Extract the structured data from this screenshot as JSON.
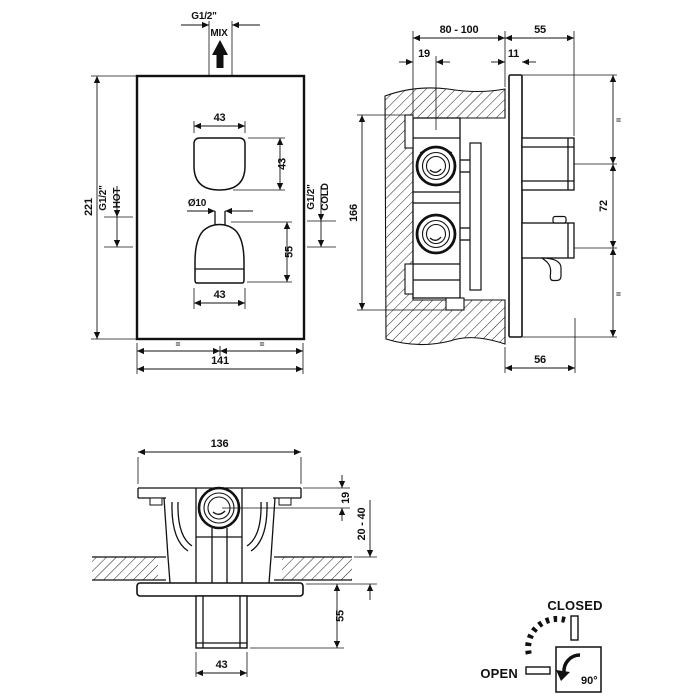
{
  "colors": {
    "line": "#111111",
    "background": "#ffffff"
  },
  "front_view": {
    "mix_thread": "G1/2\"",
    "mix_label": "MIX",
    "dim_height": "221",
    "dim_width": "141",
    "equal_left": "=",
    "equal_right": "=",
    "hot_thread": "G1/2\"",
    "hot_label": "HOT",
    "cold_thread": "G1/2\"",
    "cold_label": "COLD",
    "dim_top_handle_width": "43",
    "dim_top_handle_height": "43",
    "dim_knob_diameter": "Ø10",
    "dim_bottom_handle_height": "55",
    "dim_bottom_handle_width": "43"
  },
  "side_view": {
    "dim_recess_depth": "80 - 100",
    "dim_protrusion": "55",
    "dim_inlet_offset": "19",
    "dim_plate_gap": "11",
    "dim_body_height": "166",
    "equal_top": "=",
    "dim_handle_spacing": "72",
    "equal_bottom": "=",
    "dim_bottom_protrusion": "56"
  },
  "bottom_view": {
    "dim_body_width": "136",
    "dim_valve_offset": "19",
    "dim_wall_thickness": "20 - 40",
    "dim_handle_protrusion": "55",
    "dim_handle_width": "43"
  },
  "indicator": {
    "closed_label": "CLOSED",
    "open_label": "OPEN",
    "angle_label": "90°"
  }
}
